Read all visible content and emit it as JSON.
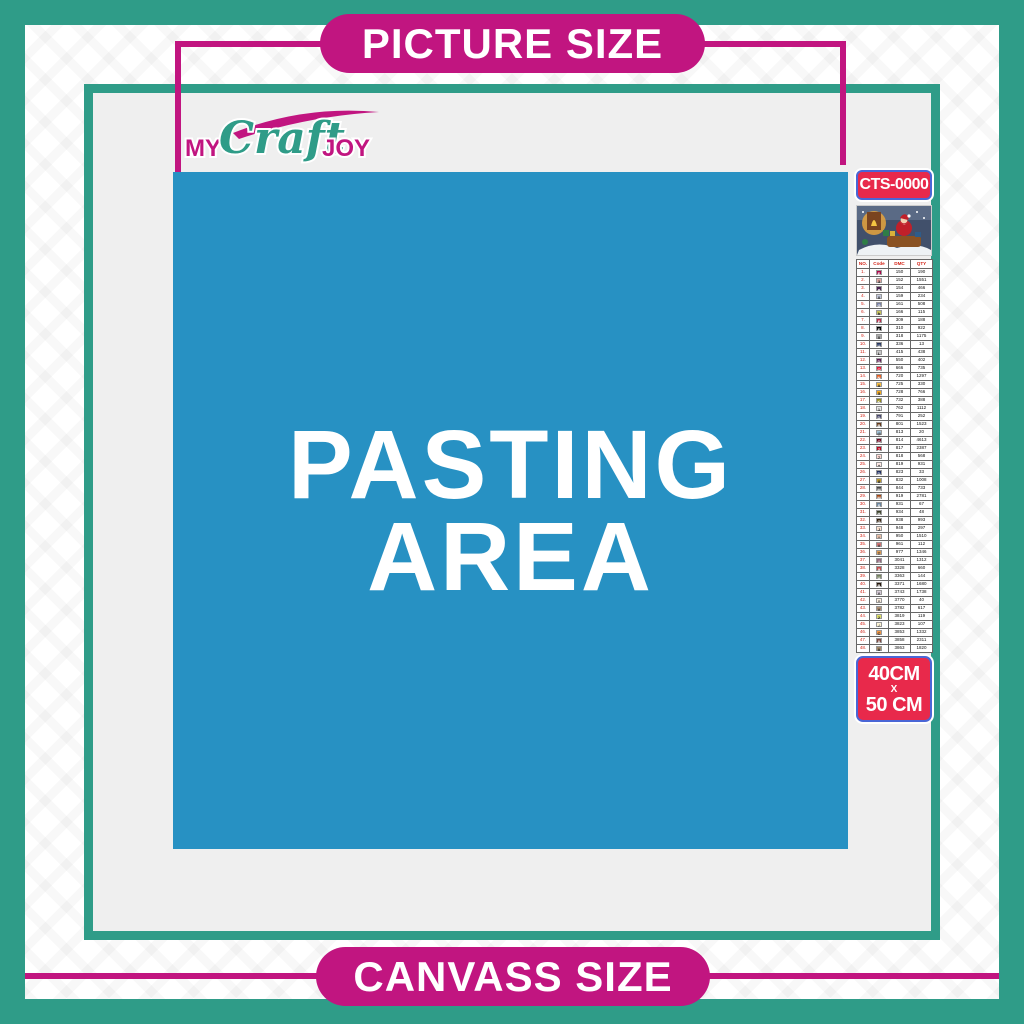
{
  "colors": {
    "teal": "#2F9C88",
    "magenta": "#C11580",
    "blue": "#2791C3",
    "red_badge": "#E8294B",
    "badge_border": "#4A66D6",
    "content_gray": "#EFEFEF"
  },
  "banners": {
    "top_label": "PICTURE SIZE",
    "bottom_label": "CANVASS SIZE"
  },
  "logo": {
    "word1": "MY",
    "word2": "Craft",
    "word3": "JOY"
  },
  "pasting_area": {
    "line1": "PASTING",
    "line2": "AREA"
  },
  "sidebar": {
    "sku": "CTS-0000",
    "thumbnail_name": "santa-christmas-scene",
    "size_badge": {
      "line1": "40CM",
      "separator": "X",
      "line2": "50 CM"
    },
    "table": {
      "headers": [
        "NO.",
        "Code",
        "DMC",
        "QTY"
      ],
      "rows": [
        {
          "no": "1.",
          "symbol": "E",
          "chip": "#AB0549",
          "dmc": "150",
          "qty": "190"
        },
        {
          "no": "2.",
          "symbol": "3",
          "chip": "#E0A6A1",
          "dmc": "152",
          "qty": "1551"
        },
        {
          "no": "3.",
          "symbol": "a",
          "chip": "#4C2653",
          "dmc": "154",
          "qty": "466"
        },
        {
          "no": "4.",
          "symbol": "X",
          "chip": "#C3C9DD",
          "dmc": "159",
          "qty": "234"
        },
        {
          "no": "5.",
          "symbol": "G",
          "chip": "#7880A4",
          "dmc": "161",
          "qty": "508"
        },
        {
          "no": "6.",
          "symbol": "h",
          "chip": "#C5C05A",
          "dmc": "166",
          "qty": "115"
        },
        {
          "no": "7.",
          "symbol": "F",
          "chip": "#BA2C4C",
          "dmc": "309",
          "qty": "188"
        },
        {
          "no": "8.",
          "symbol": "E",
          "chip": "#000000",
          "dmc": "310",
          "qty": "922"
        },
        {
          "no": "9.",
          "symbol": "X",
          "chip": "#ABABAB",
          "dmc": "318",
          "qty": "1175"
        },
        {
          "no": "10.",
          "symbol": "U",
          "chip": "#25355F",
          "dmc": "336",
          "qty": "13"
        },
        {
          "no": "11.",
          "symbol": "L",
          "chip": "#C6C6C6",
          "dmc": "415",
          "qty": "438"
        },
        {
          "no": "12.",
          "symbol": "D",
          "chip": "#5C1A51",
          "dmc": "550",
          "qty": "402"
        },
        {
          "no": "13.",
          "symbol": "O",
          "chip": "#E31C3D",
          "dmc": "666",
          "qty": "735"
        },
        {
          "no": "14.",
          "symbol": "N",
          "chip": "#E55C1F",
          "dmc": "720",
          "qty": "1297"
        },
        {
          "no": "15.",
          "symbol": "A",
          "chip": "#F7BD42",
          "dmc": "725",
          "qty": "330"
        },
        {
          "no": "16.",
          "symbol": "5",
          "chip": "#F4A91F",
          "dmc": "728",
          "qty": "766"
        },
        {
          "no": "17.",
          "symbol": "K",
          "chip": "#938B1B",
          "dmc": "732",
          "qty": "388"
        },
        {
          "no": "18.",
          "symbol": "1",
          "chip": "#E8E8E8",
          "dmc": "762",
          "qty": "1112"
        },
        {
          "no": "19.",
          "symbol": "D",
          "chip": "#45456B",
          "dmc": "791",
          "qty": "252"
        },
        {
          "no": "20.",
          "symbol": "B",
          "chip": "#653919",
          "dmc": "801",
          "qty": "1523"
        },
        {
          "no": "21.",
          "symbol": "@",
          "chip": "#A1C2D7",
          "dmc": "813",
          "qty": "20"
        },
        {
          "no": "22.",
          "symbol": "O",
          "chip": "#700822",
          "dmc": "814",
          "qty": "4613"
        },
        {
          "no": "23.",
          "symbol": "Z",
          "chip": "#BB0A23",
          "dmc": "817",
          "qty": "2387"
        },
        {
          "no": "24.",
          "symbol": "7",
          "chip": "#FFD9D3",
          "dmc": "818",
          "qty": "568"
        },
        {
          "no": "25.",
          "symbol": "+",
          "chip": "#FFE9E5",
          "dmc": "819",
          "qty": "931"
        },
        {
          "no": "26.",
          "symbol": "D",
          "chip": "#213063",
          "dmc": "823",
          "qty": "33"
        },
        {
          "no": "27.",
          "symbol": "8",
          "chip": "#BD9B33",
          "dmc": "832",
          "qty": "1008"
        },
        {
          "no": "28.",
          "symbol": "M",
          "chip": "#4A4A4A",
          "dmc": "844",
          "qty": "733"
        },
        {
          "no": "29.",
          "symbol": "M",
          "chip": "#A24512",
          "dmc": "919",
          "qty": "2781"
        },
        {
          "no": "30.",
          "symbol": "S",
          "chip": "#6A859E",
          "dmc": "931",
          "qty": "67"
        },
        {
          "no": "31.",
          "symbol": "H",
          "chip": "#3A4028",
          "dmc": "934",
          "qty": "48"
        },
        {
          "no": "32.",
          "symbol": "G",
          "chip": "#36220F",
          "dmc": "938",
          "qty": "993"
        },
        {
          "no": "33.",
          "symbol": "J",
          "chip": "#FCE2D0",
          "dmc": "948",
          "qty": "297"
        },
        {
          "no": "34.",
          "symbol": "*",
          "chip": "#E8BFA8",
          "dmc": "950",
          "qty": "1510"
        },
        {
          "no": "35.",
          "symbol": "#",
          "chip": "#CF7373",
          "dmc": "961",
          "qty": "112"
        },
        {
          "no": "36.",
          "symbol": "T",
          "chip": "#DC9C56",
          "dmc": "977",
          "qty": "1346"
        },
        {
          "no": "37.",
          "symbol": "I",
          "chip": "#93687E",
          "dmc": "3041",
          "qty": "1312"
        },
        {
          "no": "38.",
          "symbol": "9",
          "chip": "#C54F4F",
          "dmc": "3328",
          "qty": "660"
        },
        {
          "no": "39.",
          "symbol": "U",
          "chip": "#72805C",
          "dmc": "3363",
          "qty": "144"
        },
        {
          "no": "40.",
          "symbol": "B",
          "chip": "#241509",
          "dmc": "3371",
          "qty": "1680"
        },
        {
          "no": "41.",
          "symbol": "Y",
          "chip": "#D7CBD8",
          "dmc": "3743",
          "qty": "1738"
        },
        {
          "no": "42.",
          "symbol": "^",
          "chip": "#FBEEDF",
          "dmc": "3770",
          "qty": "40"
        },
        {
          "no": "43.",
          "symbol": "V",
          "chip": "#B49478",
          "dmc": "3782",
          "qty": "617"
        },
        {
          "no": "44.",
          "symbol": "2",
          "chip": "#DDE066",
          "dmc": "3819",
          "qty": "119"
        },
        {
          "no": "45.",
          "symbol": "/",
          "chip": "#FCF3D4",
          "dmc": "3823",
          "qty": "107"
        },
        {
          "no": "46.",
          "symbol": "C",
          "chip": "#F29746",
          "dmc": "3853",
          "qty": "1332"
        },
        {
          "no": "47.",
          "symbol": "0",
          "chip": "#7E4A43",
          "dmc": "3858",
          "qty": "2311"
        },
        {
          "no": "48.",
          "symbol": "A",
          "chip": "#A48A6A",
          "dmc": "3863",
          "qty": "1820"
        }
      ]
    }
  }
}
